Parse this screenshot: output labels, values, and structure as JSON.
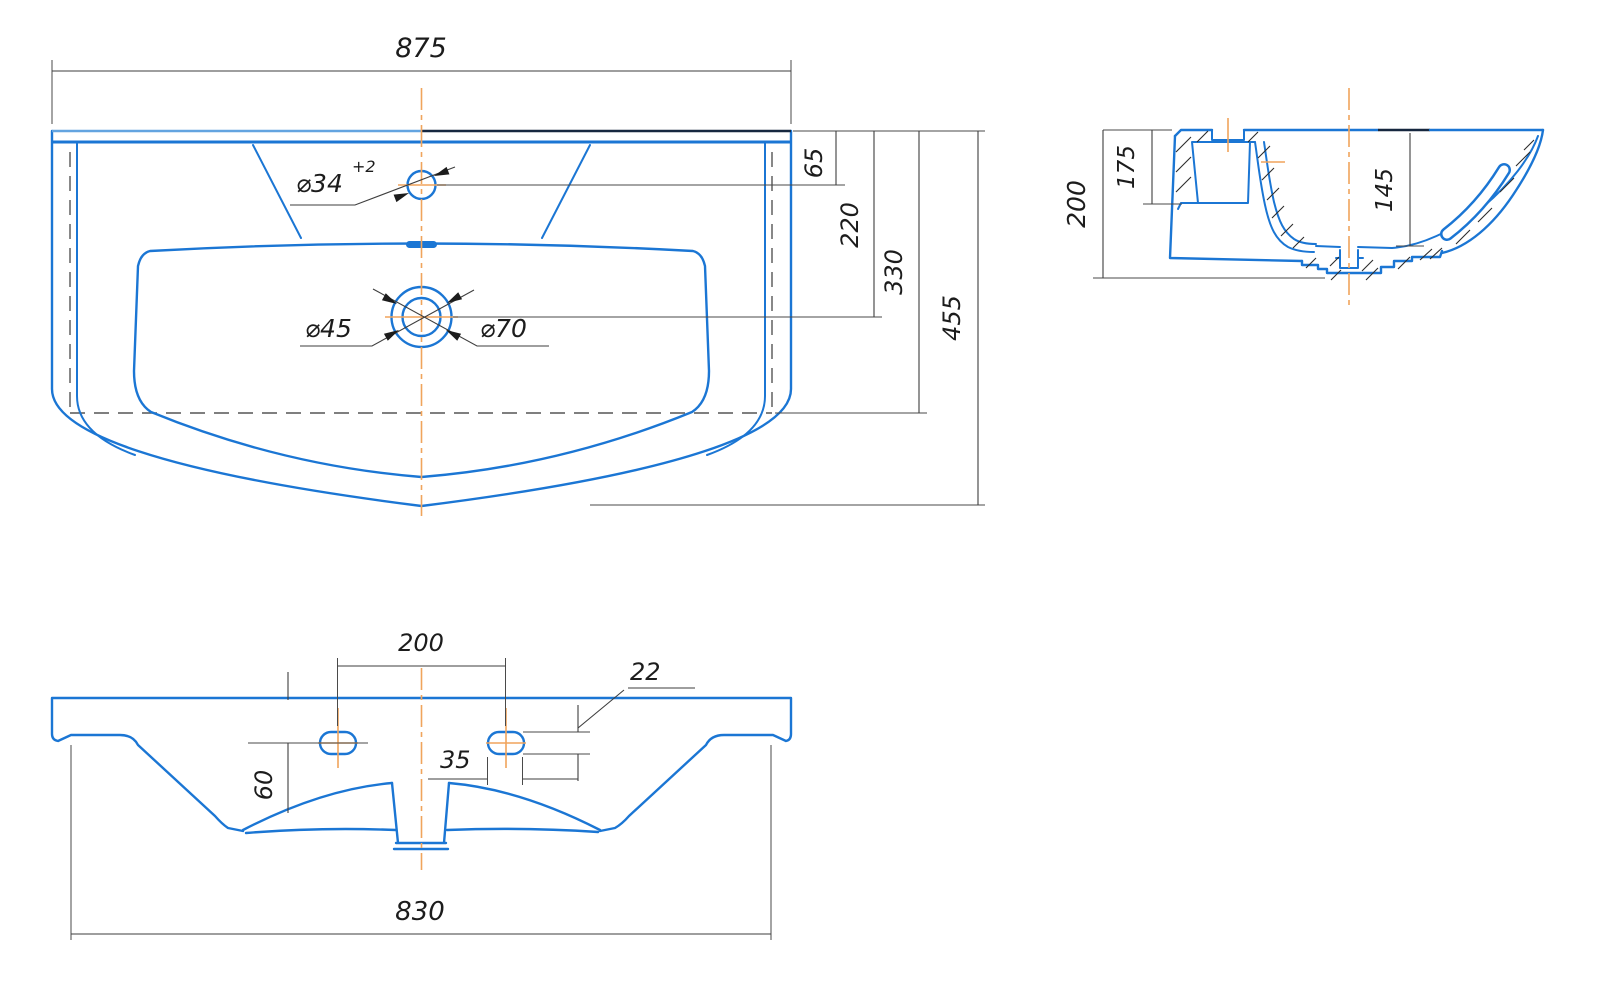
{
  "drawing": {
    "top_view": {
      "overall_width": "875",
      "faucet_hole_dia": "⌀34",
      "faucet_hole_tolerance": "+2",
      "drain_inner_dia": "⌀45",
      "drain_outer_dia": "⌀70",
      "depth_to_faucet": "65",
      "depth_to_drain": "220",
      "depth_to_inner_edge": "330",
      "overall_depth": "455"
    },
    "section_view": {
      "overall_height": "200",
      "back_wall_height": "175",
      "bowl_depth": "145"
    },
    "bottom_view": {
      "mount_hole_spacing": "200",
      "mount_hole_height": "22",
      "mount_hole_length": "35",
      "mount_hole_offset": "60",
      "base_width": "830"
    },
    "colors": {
      "outline_blue": "#1b76d4",
      "accent_dark_navy": "#16273f",
      "accent_light_blue": "#63a4e0",
      "dimension_gray": "#3e3e3e",
      "centerline_orange": "#f0a45c"
    }
  }
}
